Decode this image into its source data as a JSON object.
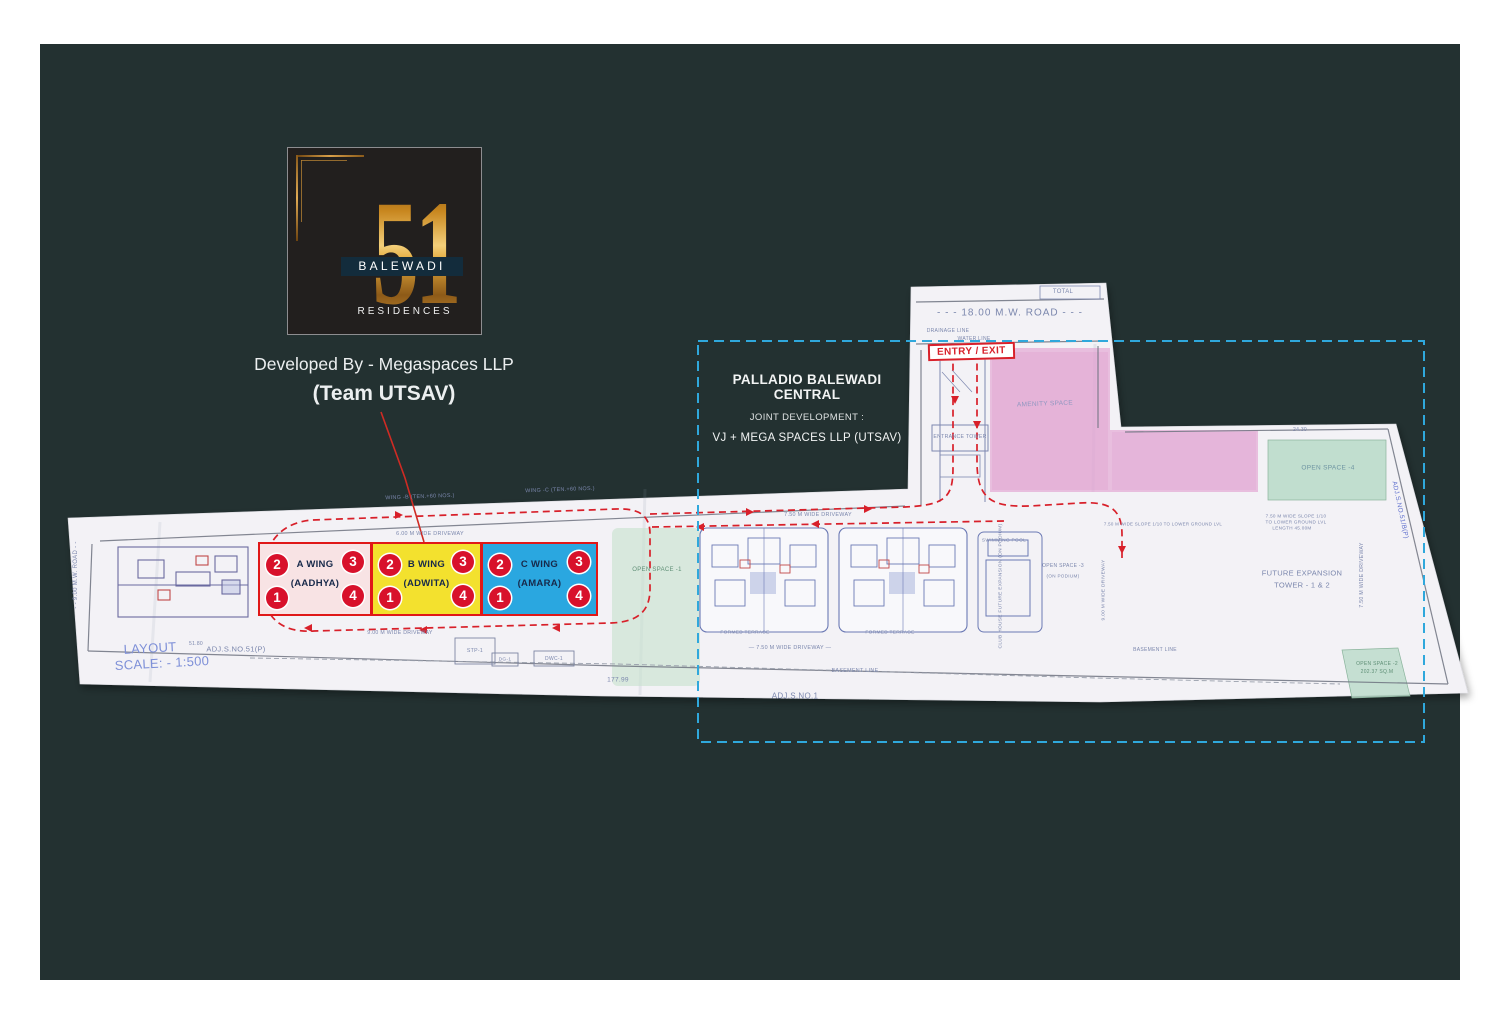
{
  "colors": {
    "background": "#233131",
    "paper": "#f3f2f6",
    "accent_red": "#d8202a",
    "badge_red": "#d8112b",
    "cyan_dashed": "#2fa8dc",
    "gold": "#cf9a3d",
    "navy_band": "#132c3c",
    "plan_ink": "#7b87ad",
    "pink_zone": "#e3a8d4",
    "green_zone": "#c9e2cf",
    "wing_a": "#f8e3e4",
    "wing_b": "#f3e12e",
    "wing_c": "#2aa7e0"
  },
  "logo": {
    "number": "51",
    "name": "BALEWADI",
    "type": "RESIDENCES"
  },
  "developer": {
    "line1": "Developed By - Megaspaces LLP",
    "line2": "(Team UTSAV)"
  },
  "palladio": {
    "title": "PALLADIO BALEWADI CENTRAL",
    "subtitle": "JOINT DEVELOPMENT :",
    "line3": "VJ +  MEGA SPACES LLP (UTSAV)"
  },
  "entry_exit": "ENTRY / EXIT",
  "wings": [
    {
      "name": "A WING",
      "alias": "(AADHYA)",
      "color": "#f8e3e4",
      "badges": [
        "2",
        "3",
        "1",
        "4"
      ]
    },
    {
      "name": "B WING",
      "alias": "(ADWITA)",
      "color": "#f3e12e",
      "badges": [
        "2",
        "3",
        "1",
        "4"
      ]
    },
    {
      "name": "C WING",
      "alias": "(AMARA)",
      "color": "#2aa7e0",
      "badges": [
        "2",
        "3",
        "1",
        "4"
      ]
    }
  ],
  "plan": {
    "labels": [
      {
        "t": "- - -   18.00  M.W.  ROAD   - - -",
        "x": 1010,
        "y": 313,
        "s": 10,
        "ls": 1
      },
      {
        "t": "TOTAL",
        "x": 1063,
        "y": 292,
        "s": 6
      },
      {
        "t": "DRAINAGE LINE",
        "x": 948,
        "y": 331,
        "s": 5
      },
      {
        "t": "WATER LINE",
        "x": 974,
        "y": 339,
        "s": 5
      },
      {
        "t": "AMENITY SPACE",
        "x": 1045,
        "y": 404,
        "s": 6.5,
        "c": "#8f97c0",
        "r": -2
      },
      {
        "t": "ENTRANCE TOWER",
        "x": 960,
        "y": 437,
        "s": 5.2
      },
      {
        "t": "OPEN SPACE -4",
        "x": 1328,
        "y": 468,
        "s": 6.5,
        "c": "#6e94a2"
      },
      {
        "t": "24.30",
        "x": 1300,
        "y": 430,
        "s": 5
      },
      {
        "t": "WING -B (TEN.+60 NOS.)",
        "x": 420,
        "y": 497,
        "s": 5.4,
        "r": -2
      },
      {
        "t": "WING -C (TEN.+60 NOS.)",
        "x": 560,
        "y": 490,
        "s": 5.4,
        "r": -2
      },
      {
        "t": "6.00 M WIDE DRIVEWAY",
        "x": 430,
        "y": 534,
        "s": 5.4
      },
      {
        "t": "7.50 M WIDE DRIVEWAY",
        "x": 818,
        "y": 515,
        "s": 5.4
      },
      {
        "t": "OPEN SPACE -1",
        "x": 657,
        "y": 570,
        "s": 6,
        "c": "#5f8f76"
      },
      {
        "t": "SWIMMING POOL",
        "x": 1004,
        "y": 541,
        "s": 4.8
      },
      {
        "t": "CLUB HOUSE  FUTURE EXPANSION  (ON PODIUM)",
        "x": 1001,
        "y": 586,
        "s": 4.8,
        "r": -90
      },
      {
        "t": "OPEN SPACE -3",
        "x": 1063,
        "y": 566,
        "s": 5
      },
      {
        "t": "(ON PODIUM)",
        "x": 1063,
        "y": 576,
        "s": 4.6
      },
      {
        "t": "9.00 M WIDE DRIVEWAY",
        "x": 1104,
        "y": 590,
        "s": 4.8,
        "r": -90
      },
      {
        "t": "FUTURE EXPANSION",
        "x": 1302,
        "y": 573,
        "s": 7.5
      },
      {
        "t": "TOWER - 1 & 2",
        "x": 1302,
        "y": 585,
        "s": 7.5
      },
      {
        "t": "7.50 M WIDE DRIVEWAY",
        "x": 1362,
        "y": 575,
        "s": 5.2,
        "r": -90
      },
      {
        "t": "ADJ.S.NO.51/B(P)",
        "x": 1400,
        "y": 510,
        "s": 6.5,
        "c": "#5d6ecd",
        "r": 78
      },
      {
        "t": "7.50 M WIDE SLOPE 1/10  TO LOWER GROUND LVL",
        "x": 1163,
        "y": 524,
        "s": 4.4
      },
      {
        "t": "7.50 M WIDE SLOPE 1/10",
        "x": 1296,
        "y": 516,
        "s": 4.6
      },
      {
        "t": "TO LOWER GROUND LVL",
        "x": 1296,
        "y": 522,
        "s": 4.6
      },
      {
        "t": "LENGTH 45.00M",
        "x": 1292,
        "y": 528,
        "s": 4.6
      },
      {
        "t": "FORMED TERRACE",
        "x": 745,
        "y": 633,
        "s": 4.8
      },
      {
        "t": "FORMED TERRACE",
        "x": 890,
        "y": 633,
        "s": 4.8
      },
      {
        "t": "9.00 M WIDE DRIVEWAY",
        "x": 400,
        "y": 633,
        "s": 5.2
      },
      {
        "t": "— 7.50 M WIDE DRIVEWAY —",
        "x": 790,
        "y": 648,
        "s": 5.4
      },
      {
        "t": "BASEMENT LINE",
        "x": 855,
        "y": 671,
        "s": 5.4
      },
      {
        "t": "BASEMENT LINE",
        "x": 1155,
        "y": 650,
        "s": 5
      },
      {
        "t": "STP-1",
        "x": 475,
        "y": 651,
        "s": 5.2
      },
      {
        "t": "DG-1",
        "x": 505,
        "y": 660,
        "s": 4.8
      },
      {
        "t": "DWC-1",
        "x": 554,
        "y": 659,
        "s": 5
      },
      {
        "t": "177.99",
        "x": 618,
        "y": 680,
        "s": 6.5
      },
      {
        "t": "ADJ.S.NO.1",
        "x": 795,
        "y": 696,
        "s": 8
      },
      {
        "t": "51.80",
        "x": 196,
        "y": 644,
        "s": 5
      },
      {
        "t": "ADJ.S.NO.51(P)",
        "x": 236,
        "y": 649,
        "s": 7.5
      },
      {
        "t": "LAYOUT",
        "x": 150,
        "y": 648,
        "s": 13,
        "c": "#7e90d8",
        "r": -3
      },
      {
        "t": "SCALE: - 1:500",
        "x": 162,
        "y": 663,
        "s": 13,
        "c": "#7e90d8",
        "r": -3
      },
      {
        "t": "- -  9.00  M.W.  ROAD  - -",
        "x": 76,
        "y": 575,
        "s": 6,
        "r": -90
      },
      {
        "t": "OPEN SPACE -2",
        "x": 1377,
        "y": 664,
        "s": 5,
        "c": "#5f8f76"
      },
      {
        "t": "202.37 SQ.M",
        "x": 1377,
        "y": 672,
        "s": 5,
        "c": "#5f8f76"
      }
    ]
  }
}
